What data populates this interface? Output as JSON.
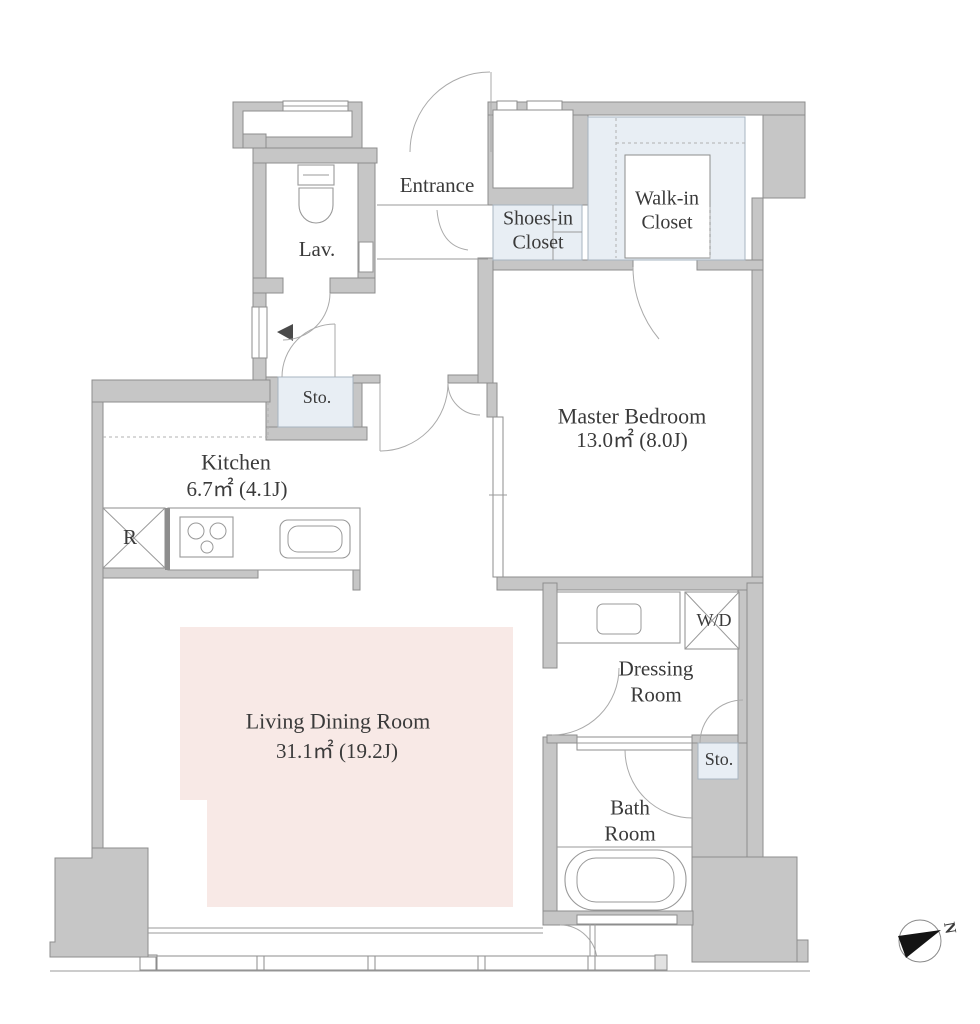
{
  "colors": {
    "wall": "#c6c6c6",
    "wall_border": "#8d8d8d",
    "closet": "#e8eef4",
    "living_pink": "#f8e9e6",
    "text": "#3a3a3a"
  },
  "rooms": {
    "entrance": {
      "label": "Entrance"
    },
    "lavatory": {
      "label": "Lav."
    },
    "storage_hall": {
      "label": "Sto."
    },
    "shoes_in_closet": {
      "label": "Shoes-in Closet"
    },
    "walk_in_closet": {
      "label": "Walk-in Closet"
    },
    "master_bedroom": {
      "label": "Master Bedroom",
      "area": "13.0㎡  (8.0J)"
    },
    "kitchen": {
      "label": "Kitchen",
      "area": "6.7㎡  (4.1J)"
    },
    "living_dining": {
      "label": "Living Dining Room",
      "area": "31.1㎡  (19.2J)"
    },
    "washer_dryer": {
      "label": "W/D"
    },
    "dressing_room": {
      "label": "Dressing Room"
    },
    "storage_dressing": {
      "label": "Sto."
    },
    "bath_room": {
      "label": "Bath Room"
    },
    "refrigerator": {
      "label": "R"
    }
  },
  "compass": {
    "label": "N"
  }
}
